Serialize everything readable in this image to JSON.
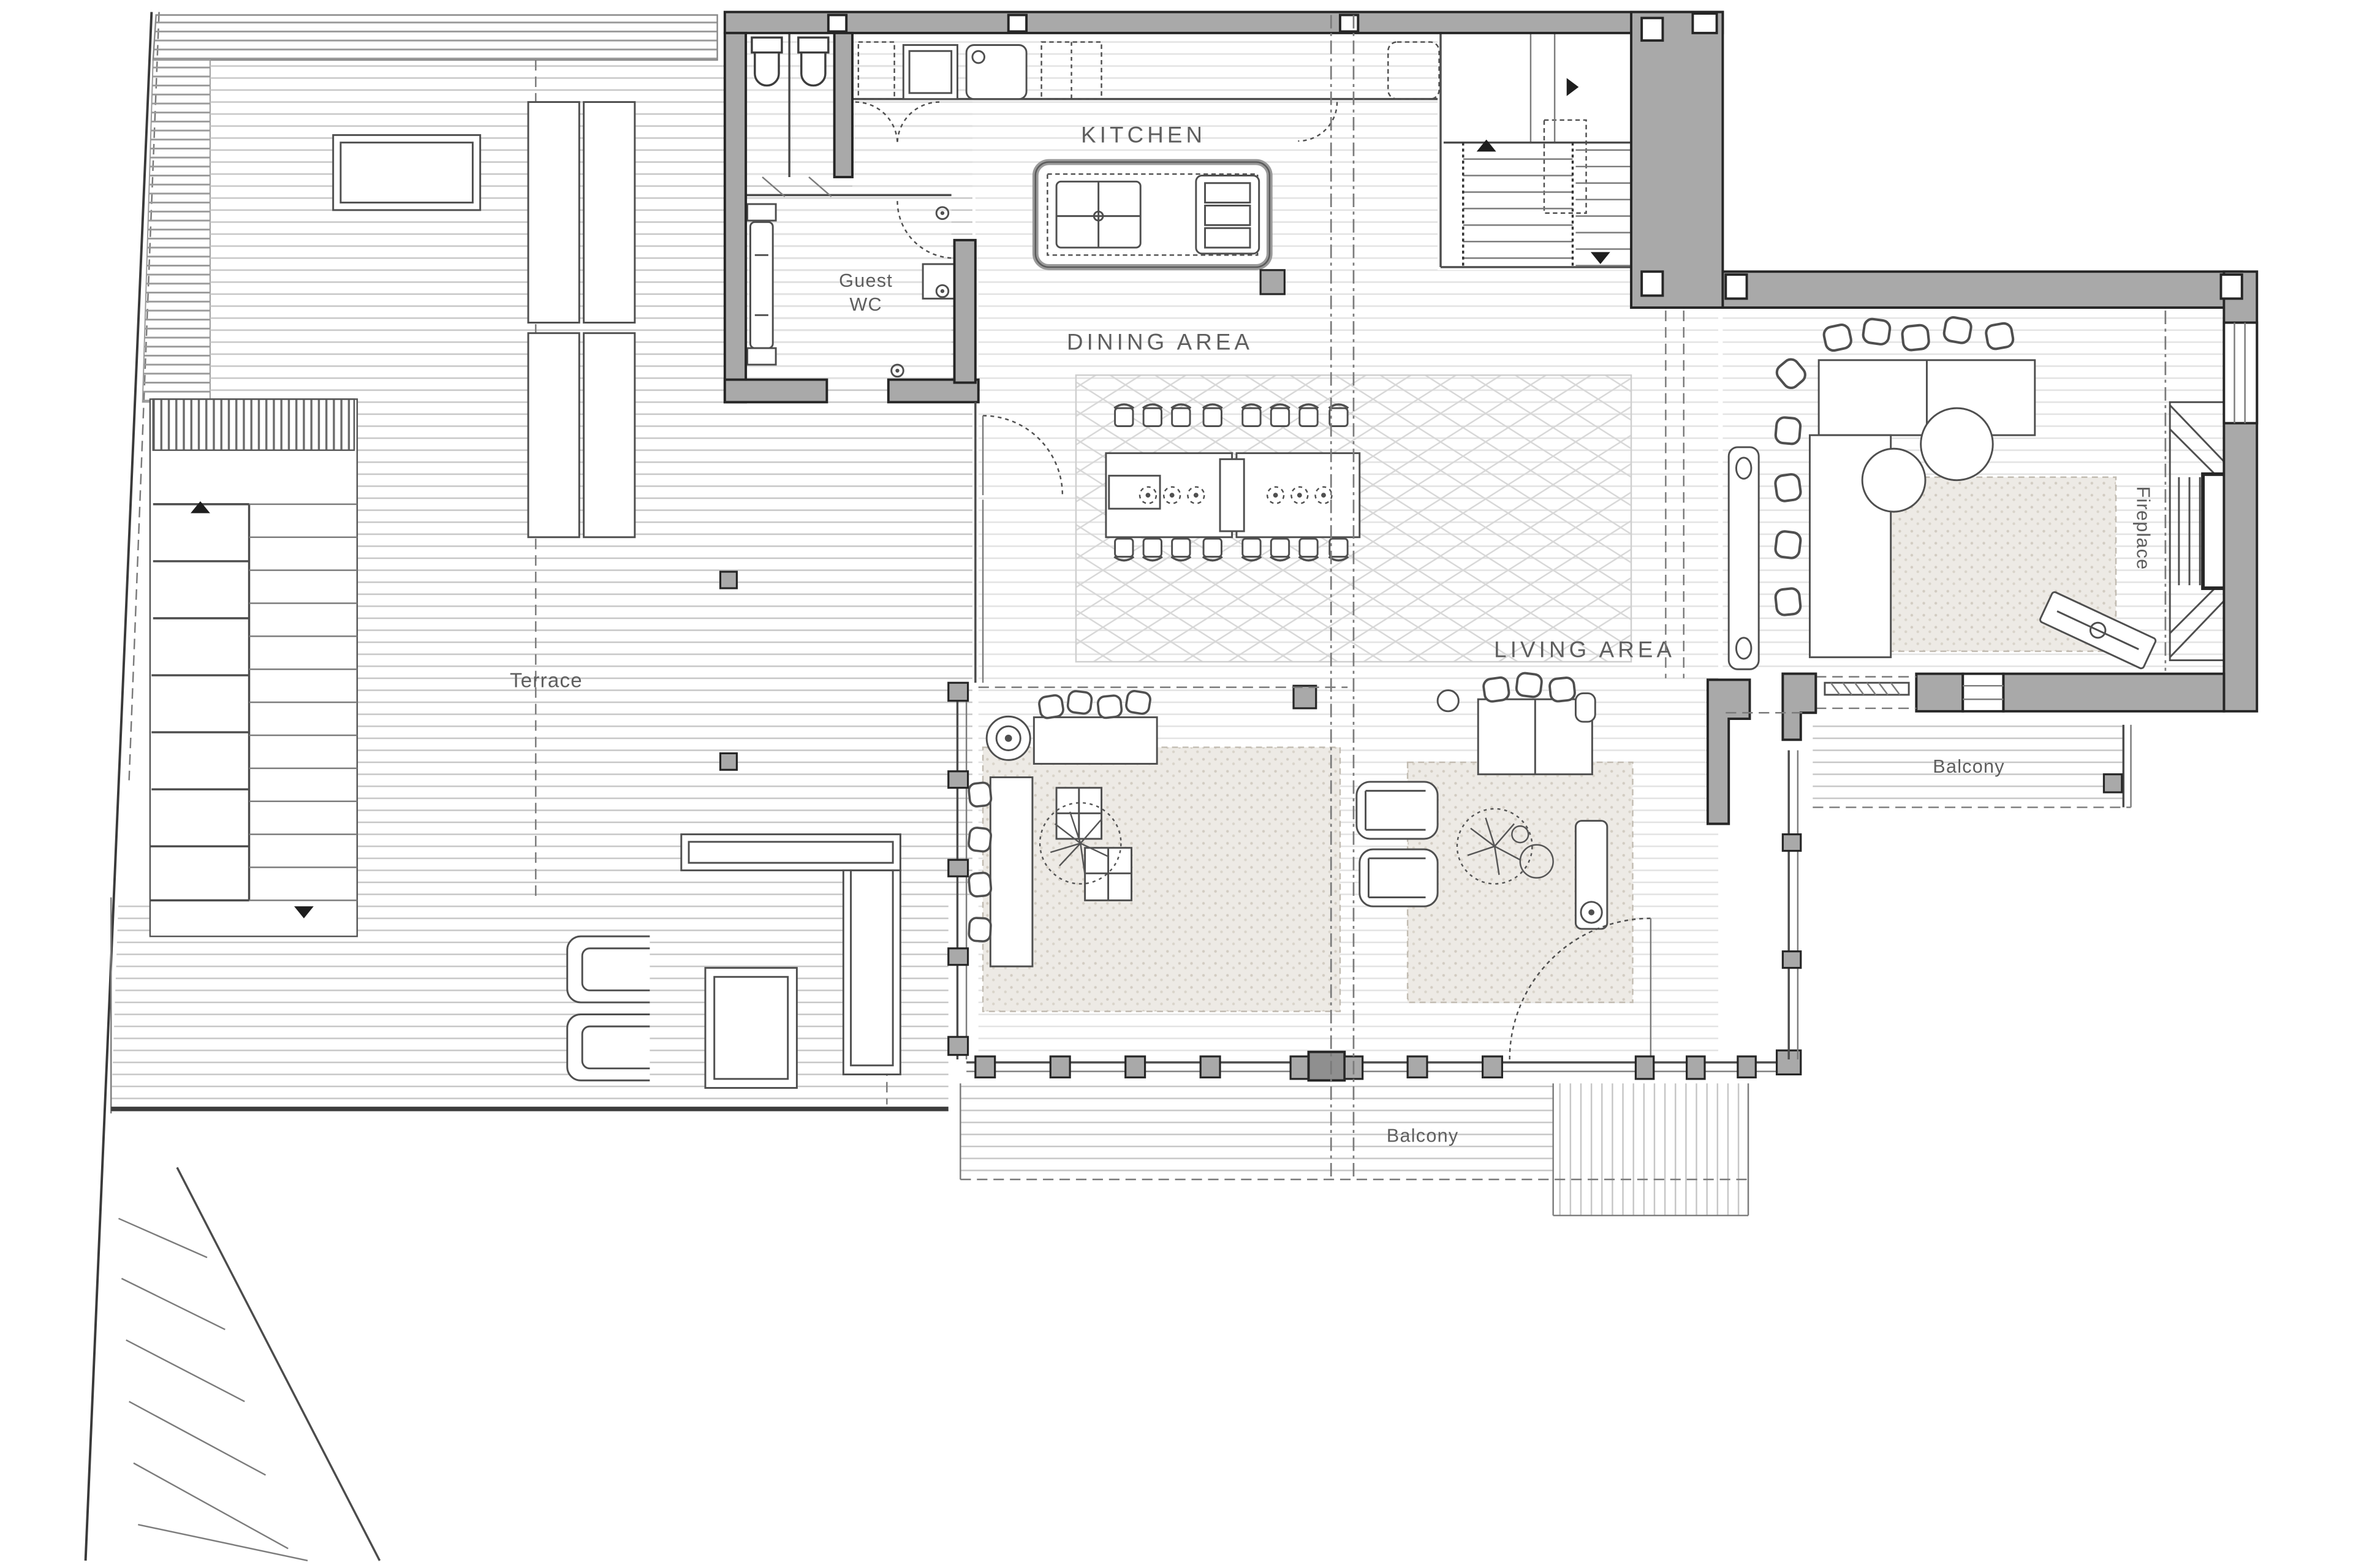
{
  "plan": {
    "labels": {
      "kitchen": "KITCHEN",
      "dining": "DINING AREA",
      "living": "LIVING AREA",
      "terrace": "Terrace",
      "guest_wc_line1": "Guest",
      "guest_wc_line2": "WC",
      "balcony_right": "Balcony",
      "balcony_bottom": "Balcony",
      "fireplace": "Fireplace"
    },
    "colors": {
      "wall_fill": "#a9a9a9",
      "wall_stroke": "#262626",
      "furn": "#4f4f4f",
      "dash": "#7a7a7a",
      "label": "#5e5e5e",
      "deck_dark": "#c6c6c6",
      "deck_light": "#e0e0e0",
      "rug_fill": "#edeae5",
      "background": "#ffffff"
    }
  }
}
